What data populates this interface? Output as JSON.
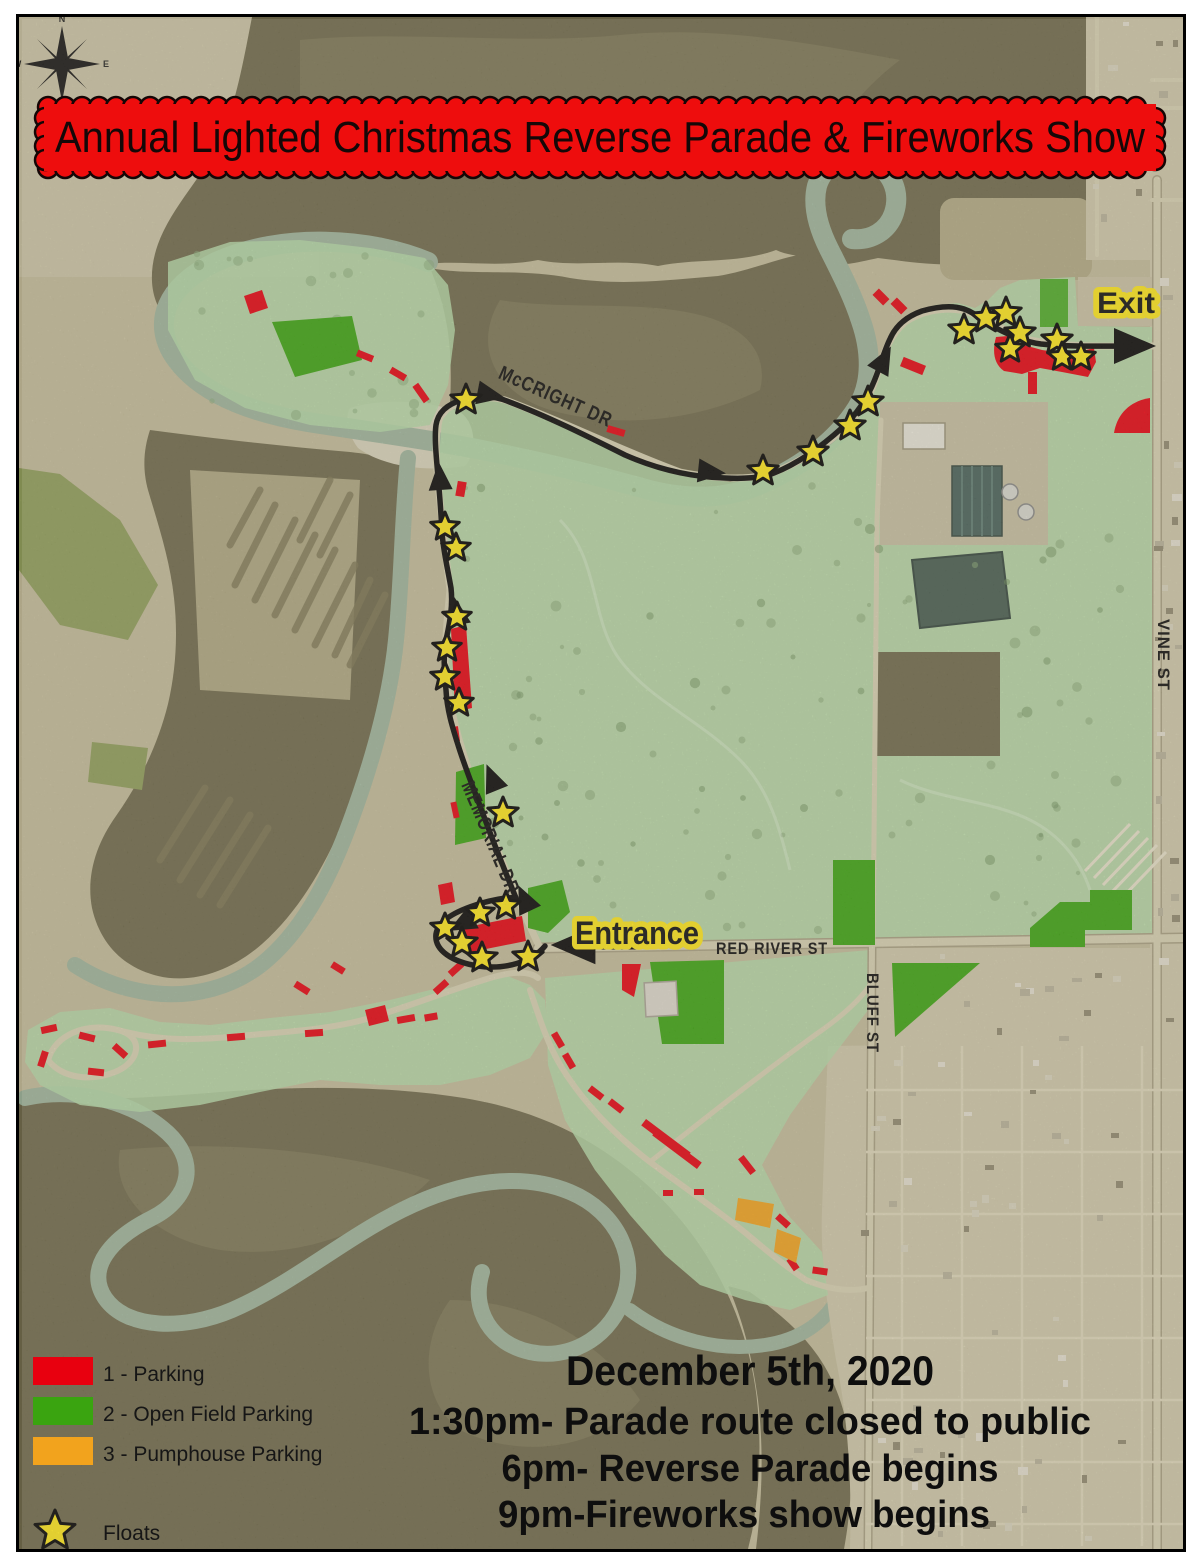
{
  "banner": {
    "title": "Annual Lighted Christmas Reverse Parade & Fireworks Show"
  },
  "compass": {
    "n": "N",
    "e": "E",
    "s": "S",
    "w": "W"
  },
  "map": {
    "street_labels": [
      {
        "id": "mccright",
        "text": "McCRIGHT DR"
      },
      {
        "id": "memorial",
        "text": "MEMORIAL DR"
      },
      {
        "id": "red_river",
        "text": "RED RIVER ST"
      },
      {
        "id": "bluff",
        "text": "BLUFF ST"
      },
      {
        "id": "vine",
        "text": "VINE ST"
      }
    ],
    "markers": {
      "entrance": "Entrance",
      "exit": "Exit"
    }
  },
  "legend": {
    "items": [
      {
        "label": "1 - Parking",
        "color": "#e8000f"
      },
      {
        "label": "2 - Open Field Parking",
        "color": "#3aa410"
      },
      {
        "label": "3 - Pumphouse Parking",
        "color": "#f2a31d"
      },
      {
        "label": "Floats",
        "color": "#ffe81a"
      }
    ]
  },
  "schedule": {
    "date": "December 5th, 2020",
    "lines": [
      "1:30pm- Parade route closed to public",
      "6pm- Reverse Parade begins",
      "9pm-Fireworks show begins"
    ]
  },
  "colors": {
    "banner_red": "#ee0d0d",
    "parking_red": "#e8000f",
    "open_field_green": "#3aa410",
    "pumphouse_orange": "#f2a31d",
    "float_yellow": "#ffe81a",
    "park_overlay_green": "#b5dba9",
    "route_black": "#050505"
  }
}
